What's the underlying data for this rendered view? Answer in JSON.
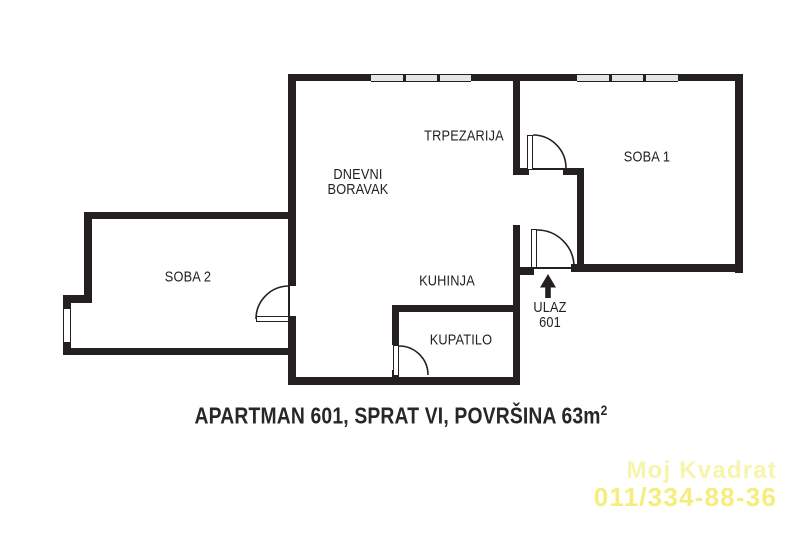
{
  "floor_plan": {
    "rooms": {
      "trpezarija": {
        "label": "TRPEZARIJA"
      },
      "dnevni_boravak": {
        "line1": "DNEVNI",
        "line2": "BORAVAK"
      },
      "soba1": {
        "label": "SOBA 1"
      },
      "soba2": {
        "label": "SOBA 2"
      },
      "kuhinja": {
        "label": "KUHINJA"
      },
      "kupatilo": {
        "label": "KUPATILO"
      },
      "ulaz": {
        "label": "ULAZ",
        "number": "601"
      }
    },
    "caption": {
      "text": "APARTMAN 601, SPRAT VI, POVRŠINA 63m",
      "area_superscript": "2"
    },
    "watermark": {
      "brand": "Moj Kvadrat",
      "phone": "011/334-88-36"
    },
    "colors": {
      "wall": "#242021",
      "window_fill": "#e5e5e5",
      "watermark_brand": "#f8f4aa",
      "watermark_phone": "#f5ee7e",
      "background": "#ffffff"
    }
  }
}
